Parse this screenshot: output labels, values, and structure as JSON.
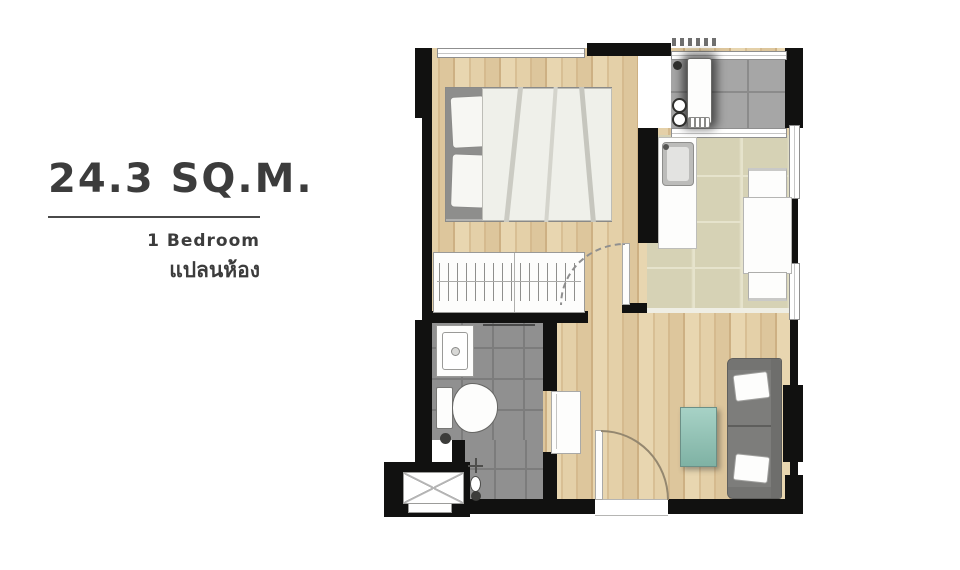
{
  "panel": {
    "area": "24.3 SQ.M.",
    "bedrooms": "1 Bedroom",
    "plan_label_thai": "แปลนห้อง"
  },
  "colors": {
    "text": "#3c3c3c",
    "wall": "#111110",
    "wood_light": "#e8d6b0",
    "wood_dark": "#cdb083",
    "tile_beige": "#d6d2b5",
    "tile_beige_grout": "#e6e3cc",
    "tile_gray": "#909090",
    "tile_gray_grout": "#7c7c7c",
    "tile_balcony": "#a6a6a6",
    "tile_balcony_grout": "#8b8b8b",
    "sofa": "#7d7d7b",
    "sofa_dark": "#6e6e6c",
    "rug_light": "#a7d2c6",
    "rug_dark": "#7fb2a4",
    "duvet": "#eff0ea",
    "headboard": "#8e8e8c",
    "fixture_white": "#fdfdfc",
    "outline_gray": "#9c9c9a"
  },
  "plan": {
    "elements": {
      "bedroom": "wood-floor room with double bed and wardrobe",
      "kitchen-dining": "beige tiled room with sink counter, table and two chairs",
      "balcony-laundry": "gray tiled balcony with washer counter and vents",
      "bathroom": "gray tiled room with vanity, toilet and shower",
      "living-room": "wood-floor room with sofa and rug",
      "ac-ledge": "outdoor condenser ledge with cross-marked unit"
    }
  }
}
